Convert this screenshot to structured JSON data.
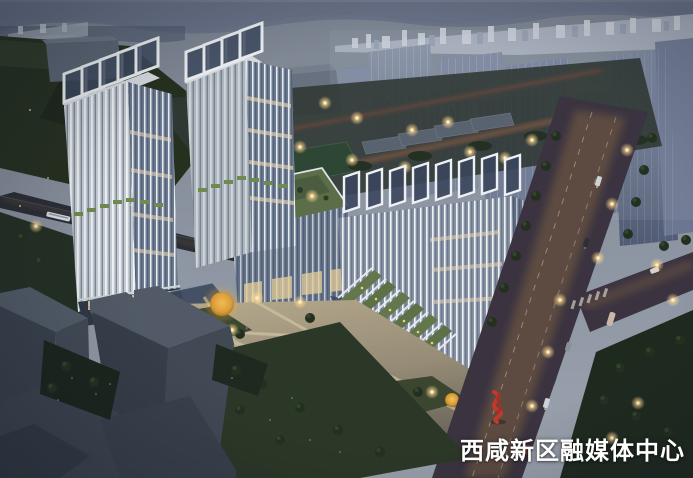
{
  "watermark": {
    "text": "西咸新区融媒体中心",
    "color": "#ffffff"
  },
  "palette": {
    "sky_top": "#7b8490",
    "sky_horizon": "#9ba3af",
    "distant_mountains": "#67718c",
    "city_skyline": "#b2b9c5",
    "background_towers": "#76819a",
    "tower_fins_white": "#eef1f3",
    "tower_glass": "#6e7c91",
    "green_roof": "#5c6d49",
    "warm_window_light": "#ecd7a2",
    "street_lamp_glow": "#ffd98f",
    "plaza_paving_lit": "#c3b595",
    "lawn_dark": "#33402c",
    "road_asphalt": "#3b3440",
    "road_warm_glow": "#7a5e42",
    "foreground_silhouette": "#434b57",
    "sculpture_red": "#c0392b",
    "autumn_tree_gold": "#d89a36"
  }
}
